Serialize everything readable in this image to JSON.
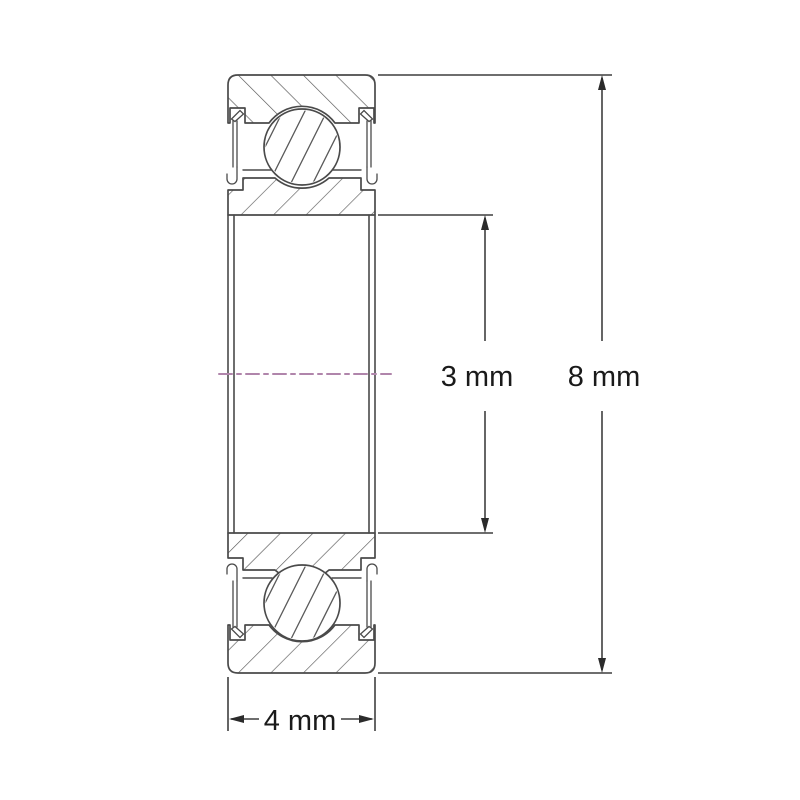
{
  "diagram": {
    "kind": "ball-bearing-cross-section",
    "labels": {
      "bore": "3 mm",
      "outer_diameter": "8 mm",
      "width": "4 mm"
    },
    "colors": {
      "background": "#ffffff",
      "drawing_line": "#4a4a4a",
      "hatch_line": "#5a5a5a",
      "dimension_line": "#3f3f3f",
      "label_text": "#1a1a1a",
      "centerline": "#b085ab"
    }
  }
}
